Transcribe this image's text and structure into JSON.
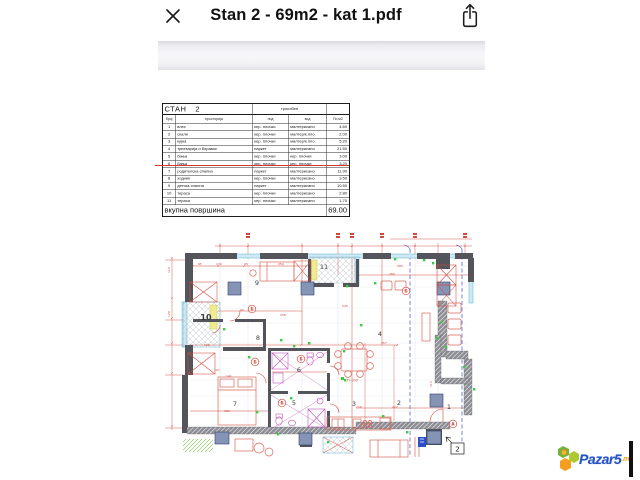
{
  "header": {
    "title": "Stan 2 - 69m2 - kat 1.pdf"
  },
  "icons": {
    "close": "close-icon",
    "share": "share-icon"
  },
  "table": {
    "name": "СТАН",
    "number": "2",
    "type_label": "трособен",
    "columns": [
      "број",
      "просторија",
      "под",
      "ѕид",
      "По м2"
    ],
    "rows": [
      [
        "1",
        "влез",
        "кер. плочки",
        "малтерисано",
        "4.60"
      ],
      [
        "2",
        "скали",
        "кер. плочки",
        "малтер/к.пло.",
        "2.00"
      ],
      [
        "3",
        "кујна",
        "кер. плочки",
        "малтер/к.пло.",
        "5.20"
      ],
      [
        "4",
        "трпезарија и боравок",
        "паркет",
        "малтерисано",
        "21.50"
      ],
      [
        "5",
        "бања",
        "кер. плочки",
        "кер. плочки",
        "3.00"
      ],
      [
        "6",
        "бања",
        "кер. плочки",
        "кер. плочки",
        "3.20"
      ],
      [
        "7",
        "родителска спална",
        "паркет",
        "малтерисано",
        "11.90"
      ],
      [
        "8",
        "ходник",
        "кер. плочки",
        "малтерисано",
        "3.50"
      ],
      [
        "9",
        "детска спална",
        "паркет",
        "малтерисано",
        "10.50"
      ],
      [
        "10",
        "тераса",
        "кер. плочки",
        "малтерисано",
        "2.80"
      ],
      [
        "11",
        "тераса",
        "кер. плочки",
        "малтерисано",
        "1.70"
      ]
    ],
    "struck_row_number": "7",
    "total_label": "вкупна површина",
    "total_value": "69.00"
  },
  "plan": {
    "room_labels": [
      {
        "text": "9",
        "x": 97,
        "y": 60
      },
      {
        "text": "10",
        "x": 46,
        "y": 95,
        "bold": true
      },
      {
        "text": "11",
        "x": 164,
        "y": 44
      },
      {
        "text": "4",
        "x": 220,
        "y": 111
      },
      {
        "text": "8",
        "x": 98,
        "y": 115
      },
      {
        "text": "6",
        "x": 139,
        "y": 147
      },
      {
        "text": "5",
        "x": 134,
        "y": 180
      },
      {
        "text": "7",
        "x": 75,
        "y": 181
      },
      {
        "text": "3",
        "x": 194,
        "y": 181
      },
      {
        "text": "2",
        "x": 239,
        "y": 180
      },
      {
        "text": "1",
        "x": 289,
        "y": 184
      }
    ],
    "markers": [
      {
        "text": "Б",
        "x": 92,
        "y": 84
      },
      {
        "text": "Б",
        "x": 95,
        "y": 137
      },
      {
        "text": "Б",
        "x": 141,
        "y": 134
      },
      {
        "text": "Б",
        "x": 122,
        "y": 178
      },
      {
        "text": "Б",
        "x": 246,
        "y": 66
      },
      {
        "text": "А",
        "x": 293,
        "y": 199
      }
    ],
    "section_marker": "2",
    "equipment_label": "П-100",
    "dims": [
      {
        "text": "65",
        "x": 38,
        "y": 40
      },
      {
        "text": "130",
        "x": 56,
        "y": 40
      },
      {
        "text": "95",
        "x": 84,
        "y": 40
      },
      {
        "text": "250",
        "x": 118,
        "y": 40
      },
      {
        "text": "305",
        "x": 237,
        "y": 42
      },
      {
        "text": "280",
        "x": 229,
        "y": 50
      },
      {
        "text": "545",
        "x": 182,
        "y": 82
      },
      {
        "text": "258",
        "x": 120,
        "y": 91
      },
      {
        "text": "90",
        "x": 80,
        "y": 86
      },
      {
        "text": "457",
        "x": 221,
        "y": 119
      },
      {
        "text": "126",
        "x": 44,
        "y": 121
      },
      {
        "text": "107",
        "x": 54,
        "y": 146
      },
      {
        "text": "141",
        "x": 66,
        "y": 152
      },
      {
        "text": "363",
        "x": 64,
        "y": 187
      },
      {
        "text": "236",
        "x": 196,
        "y": 183
      },
      {
        "text": "222",
        "x": 232,
        "y": 183
      },
      {
        "text": "113",
        "x": 272,
        "y": 162,
        "rot": -90
      },
      {
        "text": "116",
        "x": 10,
        "y": 48,
        "rot": -90
      },
      {
        "text": "120",
        "x": 10,
        "y": 92,
        "rot": -90
      }
    ],
    "green_dots": [
      [
        63,
        103
      ],
      [
        88,
        131
      ],
      [
        120,
        114
      ],
      [
        133,
        120
      ],
      [
        148,
        117
      ],
      [
        183,
        125
      ],
      [
        200,
        99
      ],
      [
        214,
        57
      ],
      [
        234,
        33
      ],
      [
        263,
        34
      ],
      [
        272,
        37
      ],
      [
        280,
        96
      ],
      [
        285,
        121
      ],
      [
        303,
        141
      ],
      [
        313,
        163
      ],
      [
        130,
        172
      ],
      [
        96,
        186
      ],
      [
        117,
        208
      ],
      [
        167,
        216
      ],
      [
        222,
        190
      ],
      [
        246,
        206
      ],
      [
        276,
        112
      ],
      [
        184,
        154
      ],
      [
        186,
        60
      ]
    ]
  },
  "watermark": {
    "brand": "Pazar5",
    "suffix": ".mk"
  },
  "colors": {
    "accent_red": "#d24a3e",
    "wall_gray": "#54555b",
    "window_cyan": "#cfeaf4",
    "dash_blue": "#4653c4",
    "fixture_magenta": "#c255b8",
    "highlight_yellow": "#f1eb90",
    "green_marker": "#3fca45",
    "strike_red": "#d5382c",
    "brand_blue": "#2853c6",
    "brand_orange": "#f0a21c",
    "brand_green": "#71b33c"
  }
}
